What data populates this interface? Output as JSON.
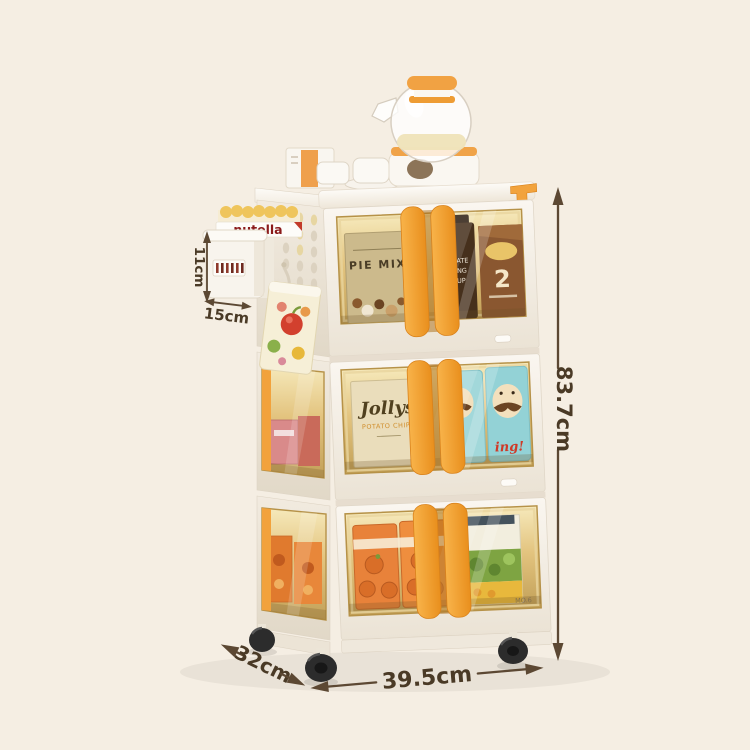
{
  "scene": {
    "description": "3-tier foldable snack storage trolley on wheels, shown with teapot set on top, side hanging basket and measurement annotations",
    "background_color": "#f5eee3"
  },
  "annotations": {
    "height": "83.7cm",
    "width": "39.5cm",
    "depth": "32cm",
    "basket_height": "11cm",
    "basket_width": "15cm"
  },
  "products": {
    "tier1": {
      "pie_mix": "PIE MIX",
      "bottle_line1": "LATE",
      "bottle_line2": "ING",
      "bottle_line3": "UP",
      "pack_digit": "2"
    },
    "tier2": {
      "chips_brand": "Jollys",
      "chips_type": "POTATO CHIPS",
      "can_script": "ing!"
    },
    "tier3": {
      "watermark": "MO.6"
    },
    "basket": {
      "jar_brand": "nutella"
    }
  },
  "colors": {
    "cart_body": "#f6f1ea",
    "handle_orange": "#f2a23c",
    "window_amber": "#d9b873",
    "annotation_brown": "#5c4833",
    "wheel_black": "#2c2c2c"
  }
}
